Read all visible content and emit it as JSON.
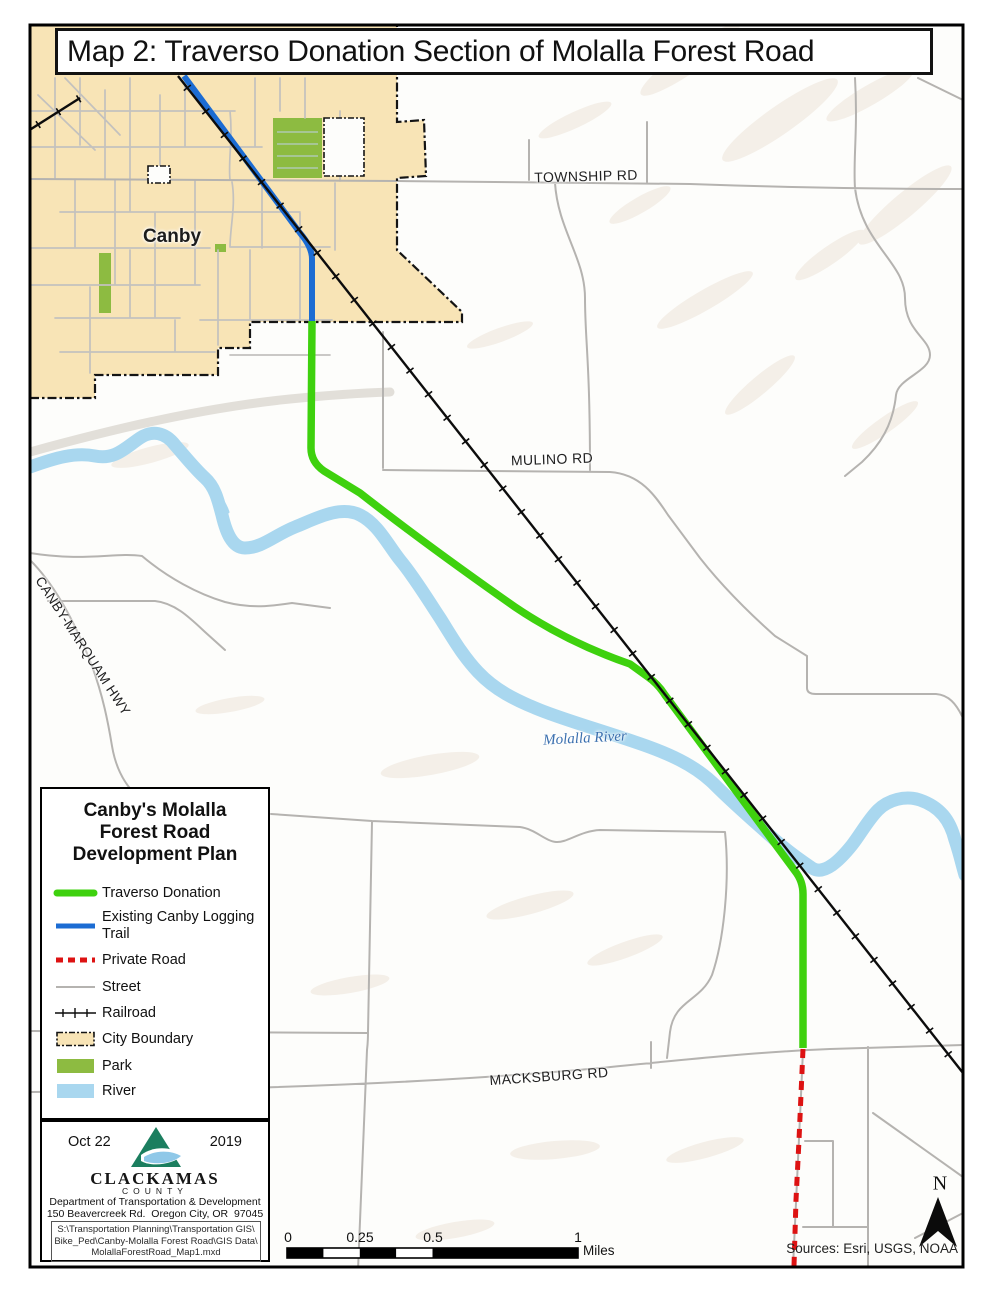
{
  "title": {
    "text": "Map 2: Traverso Donation Section of Molalla Forest Road"
  },
  "map_labels": {
    "city": "Canby",
    "township_rd": "TOWNSHIP RD",
    "mulino_rd": "MULINO RD",
    "macksburg_rd": "MACKSBURG RD",
    "canby_marquam_hwy": "CANBY-MARQUAM HWY",
    "river": "Molalla River"
  },
  "legend": {
    "title_lines": [
      "Canby's Molalla",
      "Forest Road",
      "Development Plan"
    ],
    "items": [
      {
        "label": "Traverso Donation",
        "symbol": "green-line"
      },
      {
        "label": "Existing Canby Logging Trail",
        "symbol": "blue-line"
      },
      {
        "label": "Private Road",
        "symbol": "red-dashed-line"
      },
      {
        "label": "Street",
        "symbol": "gray-line"
      },
      {
        "label": "Railroad",
        "symbol": "railroad-line"
      },
      {
        "label": "City Boundary",
        "symbol": "tan-dashed-box"
      },
      {
        "label": "Park",
        "symbol": "green-box"
      },
      {
        "label": "River",
        "symbol": "blue-box"
      }
    ]
  },
  "info_box": {
    "date_left": "Oct 22",
    "date_right": "2019",
    "org": "CLACKAMAS",
    "org_sub": "COUNTY",
    "dept": "Department of Transportation & Development",
    "address": "150 Beavercreek Rd.  Oregon City, OR  97045",
    "path_lines": [
      "S:\\Transportation Planning\\Transportation GIS\\",
      "Bike_Ped\\Canby-Molalla Forest Road\\GIS Data\\",
      "MolallaForestRoad_Map1.mxd"
    ]
  },
  "scale_bar": {
    "labels": [
      "0",
      "0.25",
      "0.5",
      "1"
    ],
    "unit": "Miles"
  },
  "compass": {
    "n": "N"
  },
  "sources": {
    "text": "Sources: Esri, USGS, NOAA"
  },
  "colors": {
    "traverso_green": "#3ED10E",
    "logging_blue": "#1C6CD3",
    "private_red": "#DD1212",
    "street_gray": "#B5B3B0",
    "railroad_black": "#0C0C0C",
    "city_fill": "#F8E4B6",
    "park_green": "#8DBB41",
    "river_blue": "#A9D7EF",
    "boundary_black": "#141414",
    "terrain_tint": "#EDE4D9"
  }
}
